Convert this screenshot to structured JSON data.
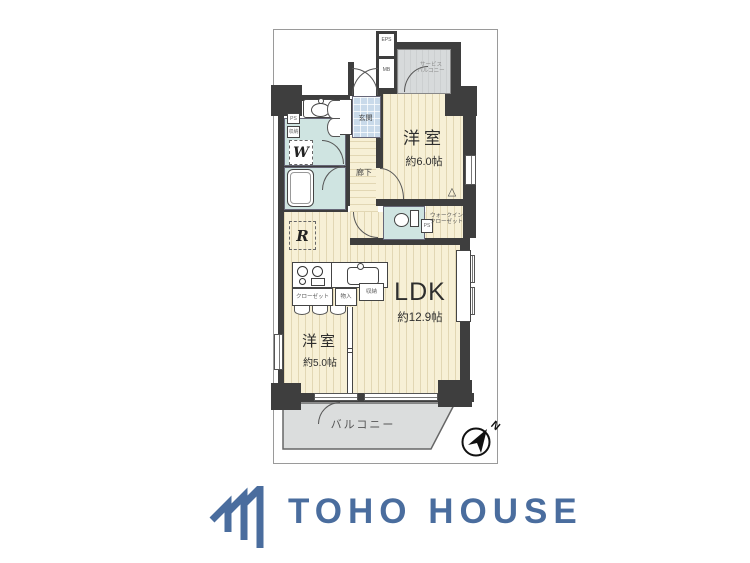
{
  "colors": {
    "wall": "#3e3e3e",
    "floor": "#f7f0d6",
    "wet_area": "#cfe4e1",
    "entrance_tile": "#c9daea",
    "balcony_gray": "#d7dadb",
    "logo_blue": "#4a6d9e"
  },
  "plan": {
    "rooms": {
      "bedroom1": {
        "name": "洋室",
        "size": "約6.0帖"
      },
      "ldk": {
        "name": "LDK",
        "size": "約12.9帖"
      },
      "bedroom2": {
        "name": "洋室",
        "size": "約5.0帖"
      }
    },
    "labels": {
      "service_balcony_l1": "サービス",
      "service_balcony_l2": "バルコニー",
      "balcony": "バルコニー",
      "entrance": "玄関",
      "hallway": "廊下",
      "wic_l1": "ウォークイン",
      "wic_l2": "クローゼット",
      "closet": "クローゼット",
      "storage1": "物入",
      "storage2": "収納",
      "washer": "W",
      "fridge": "R",
      "eps": "EPS",
      "mb": "MB",
      "ps_wic": "PS",
      "ps_wall": "PS",
      "storage_wall": "収納"
    },
    "compass": {
      "north": "N"
    }
  },
  "logo": {
    "text": "TOHO HOUSE"
  }
}
